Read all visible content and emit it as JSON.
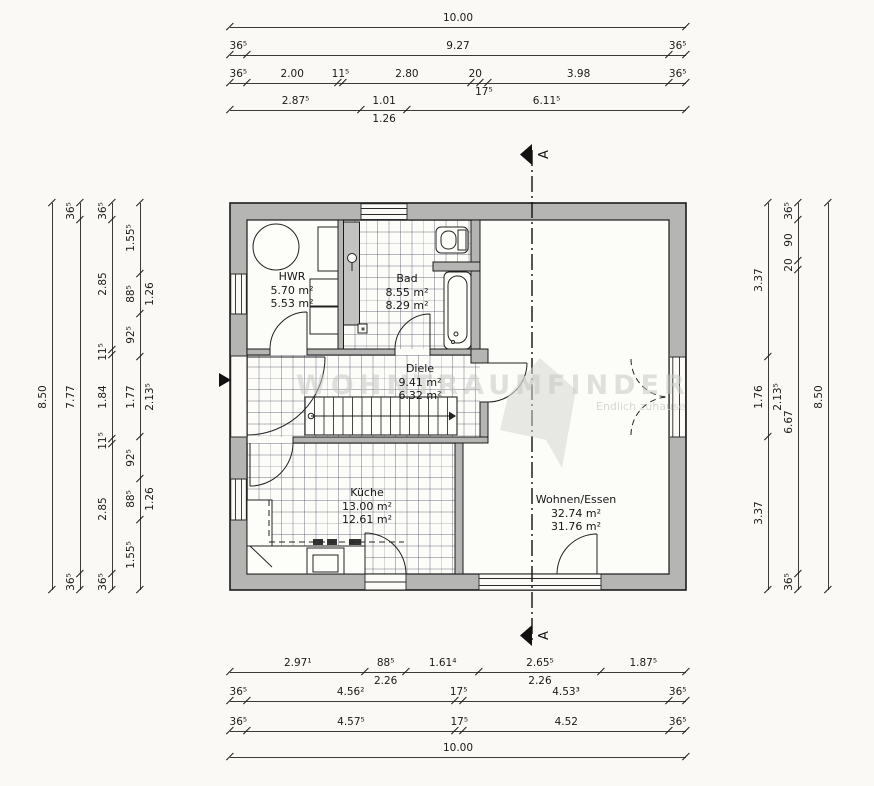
{
  "rooms": {
    "hwr": {
      "name": "HWR",
      "area_gross": "5.70 m²",
      "area_net": "5.53 m²"
    },
    "bad": {
      "name": "Bad",
      "area_gross": "8.55 m²",
      "area_net": "8.29 m²"
    },
    "diele": {
      "name": "Diele",
      "area_gross": "9.41 m²",
      "area_net": "6.32 m²"
    },
    "kueche": {
      "name": "Küche",
      "area_gross": "13.00 m²",
      "area_net": "12.61 m²"
    },
    "wohnen": {
      "name": "Wohnen/Essen",
      "area_gross": "32.74 m²",
      "area_net": "31.76 m²"
    }
  },
  "section": {
    "label": "A"
  },
  "watermark": {
    "brand": "WOHNTRAUMFINDER",
    "tagline": "Endlich zuhause"
  },
  "dimensions": {
    "top": [
      {
        "segments": [
          {
            "label": "10.00",
            "v": 10.0
          }
        ]
      },
      {
        "segments": [
          {
            "label": "36⁵",
            "v": 0.365
          },
          {
            "label": "9.27",
            "v": 9.27
          },
          {
            "label": "36⁵",
            "v": 0.365
          }
        ]
      },
      {
        "segments": [
          {
            "label": "36⁵",
            "v": 0.365
          },
          {
            "label": "2.00",
            "v": 2.0
          },
          {
            "label": "11⁵",
            "v": 0.115
          },
          {
            "label": "2.80",
            "v": 2.8
          },
          {
            "label": "20",
            "v": 0.2
          },
          {
            "label": "17⁵",
            "v": 0.175,
            "below": true
          },
          {
            "label": "3.98",
            "v": 3.98
          },
          {
            "label": "36⁵",
            "v": 0.365
          }
        ]
      },
      {
        "segments": [
          {
            "label": "2.87⁵",
            "v": 2.875
          },
          {
            "label": "1.01",
            "v": 1.01,
            "sub": "1.26"
          },
          {
            "label": "6.11⁵",
            "v": 6.115
          }
        ]
      }
    ],
    "bottom": [
      {
        "segments": [
          {
            "label": "2.97¹",
            "v": 2.971
          },
          {
            "label": "88⁵",
            "v": 0.885,
            "sub": "2.26"
          },
          {
            "label": "1.61⁴",
            "v": 1.614
          },
          {
            "label": "2.65⁵",
            "v": 2.655,
            "sub": "2.26"
          },
          {
            "label": "1.87⁵",
            "v": 1.875
          }
        ]
      },
      {
        "segments": [
          {
            "label": "36⁵",
            "v": 0.365
          },
          {
            "label": "4.56²",
            "v": 4.562
          },
          {
            "label": "17⁵",
            "v": 0.175
          },
          {
            "label": "4.53³",
            "v": 4.533
          },
          {
            "label": "36⁵",
            "v": 0.365
          }
        ]
      },
      {
        "segments": [
          {
            "label": "36⁵",
            "v": 0.365
          },
          {
            "label": "4.57⁵",
            "v": 4.575
          },
          {
            "label": "17⁵",
            "v": 0.175
          },
          {
            "label": "4.52",
            "v": 4.52
          },
          {
            "label": "36⁵",
            "v": 0.365
          }
        ]
      },
      {
        "segments": [
          {
            "label": "10.00",
            "v": 10.0
          }
        ]
      }
    ],
    "left": [
      {
        "segments": [
          {
            "label": "8.50",
            "v": 8.5
          }
        ]
      },
      {
        "segments": [
          {
            "label": "36⁵",
            "v": 0.365
          },
          {
            "label": "7.77",
            "v": 7.77
          },
          {
            "label": "36⁵",
            "v": 0.365
          }
        ]
      },
      {
        "segments": [
          {
            "label": "36⁵",
            "v": 0.365
          },
          {
            "label": "2.85",
            "v": 2.85
          },
          {
            "label": "11⁵",
            "v": 0.115
          },
          {
            "label": "1.84",
            "v": 1.84
          },
          {
            "label": "11⁵",
            "v": 0.115
          },
          {
            "label": "2.85",
            "v": 2.85
          },
          {
            "label": "36⁵",
            "v": 0.365
          }
        ]
      },
      {
        "segments": [
          {
            "label": "1.55⁵",
            "v": 1.555
          },
          {
            "label": "88⁵",
            "v": 0.885,
            "sub": "1.26"
          },
          {
            "label": "92⁵",
            "v": 0.925
          },
          {
            "label": "1.77",
            "v": 1.77,
            "sub": "2.13⁵"
          },
          {
            "label": "92⁵",
            "v": 0.925
          },
          {
            "label": "88⁵",
            "v": 0.885,
            "sub": "1.26"
          },
          {
            "label": "1.55⁵",
            "v": 1.555
          }
        ]
      }
    ],
    "right": [
      {
        "segments": [
          {
            "label": "3.37",
            "v": 3.37
          },
          {
            "label": "1.76",
            "v": 1.76,
            "sub": "2.13⁵"
          },
          {
            "label": "3.37",
            "v": 3.37
          }
        ]
      },
      {
        "segments": [
          {
            "label": "36⁵",
            "v": 0.365
          },
          {
            "label": "90",
            "v": 0.9
          },
          {
            "label": "20",
            "v": 0.2
          },
          {
            "label": "6.67",
            "v": 6.67
          },
          {
            "label": "36⁵",
            "v": 0.365
          }
        ]
      },
      {
        "segments": [
          {
            "label": "8.50",
            "v": 8.5
          }
        ]
      }
    ]
  }
}
